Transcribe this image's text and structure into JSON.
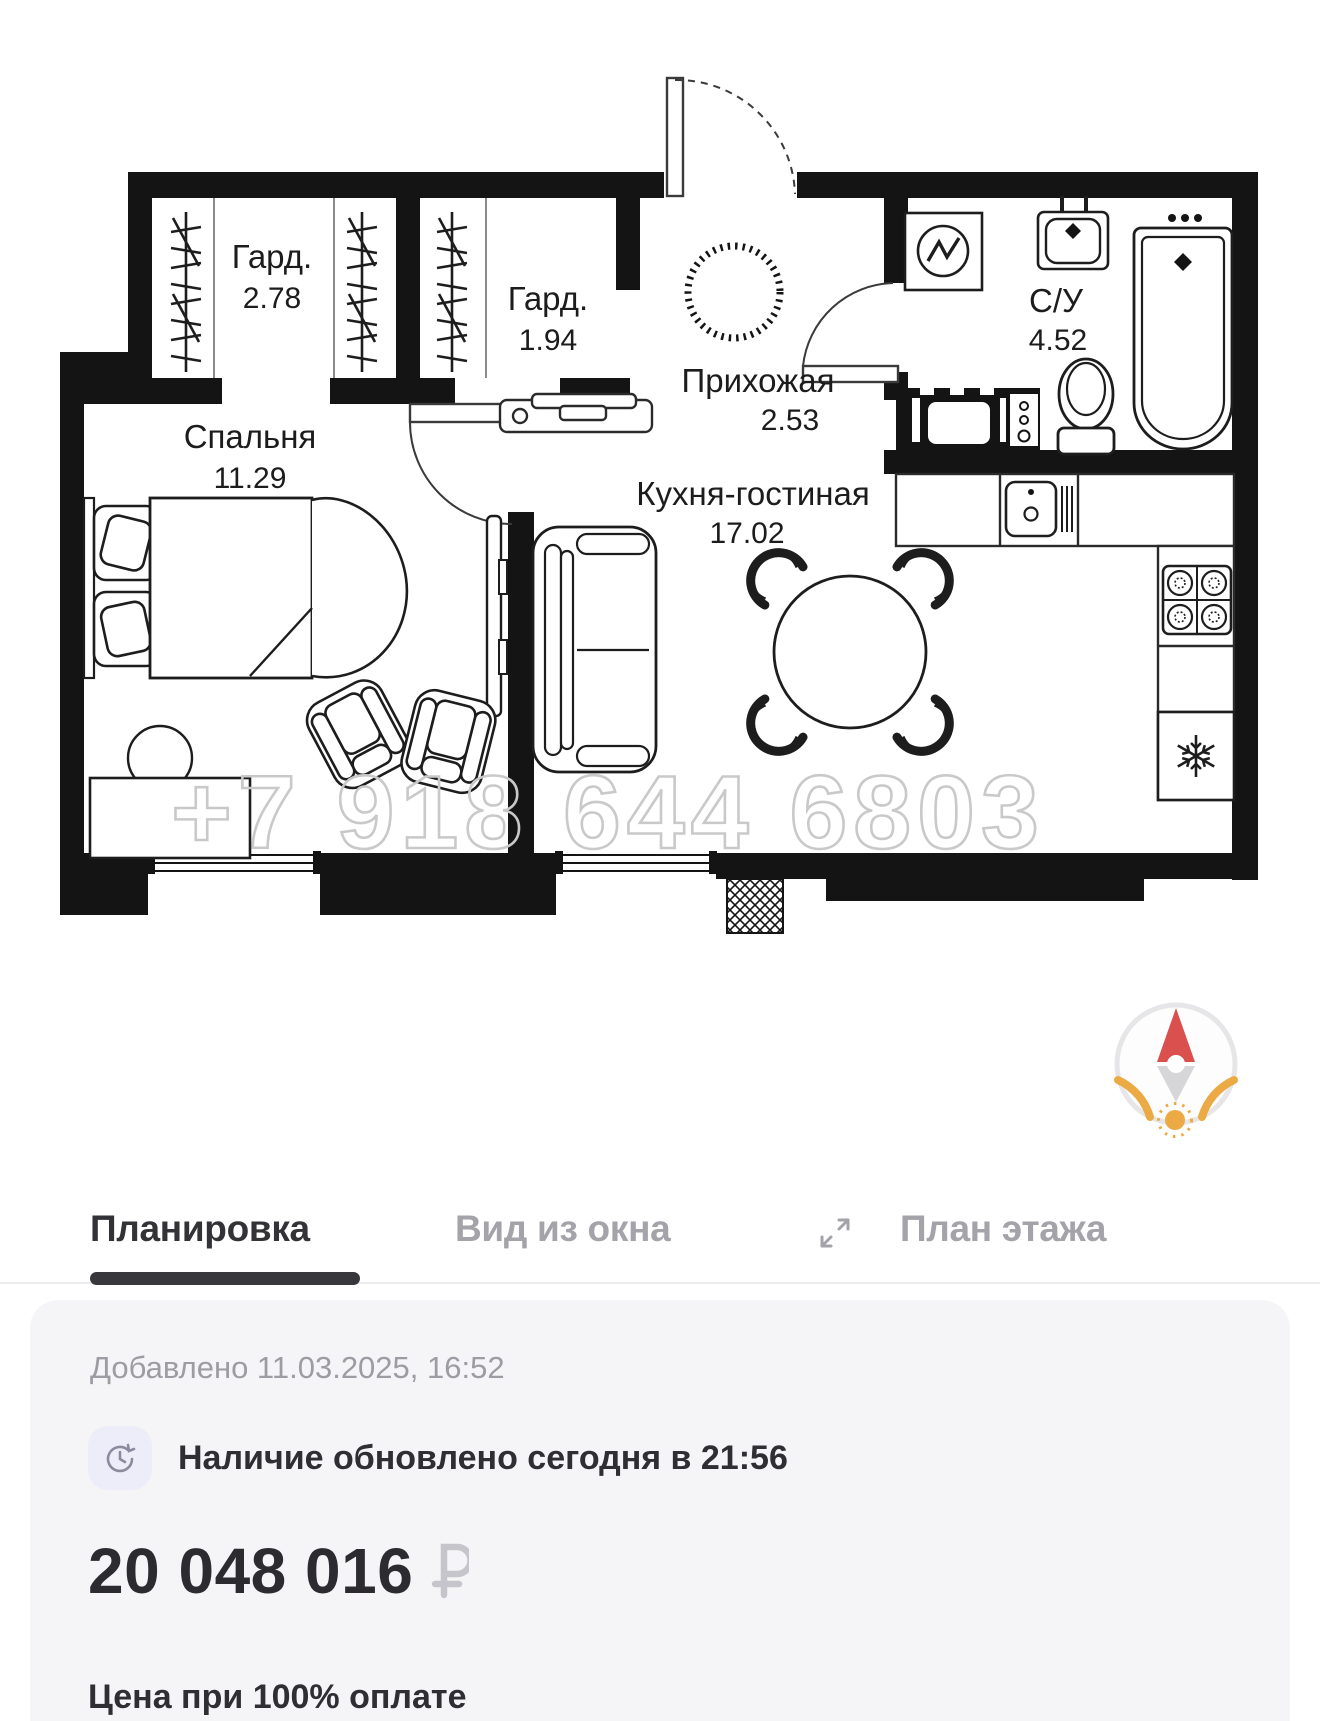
{
  "floor_plan": {
    "watermark": "+7 918 644 6803",
    "rooms": [
      {
        "name": "Гард.",
        "area": "2.78"
      },
      {
        "name": "Гард.",
        "area": "1.94"
      },
      {
        "name": "Прихожая",
        "area": "2.53"
      },
      {
        "name": "С/У",
        "area": "4.52"
      },
      {
        "name": "Спальня",
        "area": "11.29"
      },
      {
        "name": "Кухня-гостиная",
        "area": "17.02"
      }
    ],
    "fixtures": [
      "hanger-rack",
      "entrance-door",
      "electrical-panel",
      "washing-machine",
      "sink",
      "bathtub",
      "toilet",
      "kitchen-sink",
      "stove",
      "fridge",
      "sofa",
      "dining-table",
      "bed",
      "desk",
      "armchair",
      "tv",
      "window"
    ]
  },
  "compass": {
    "needle_up_color": "#d9504f",
    "needle_down_color": "#d6d6d9",
    "arc_color": "#ecaa44",
    "ring_color": "#e6e6e9",
    "sun_color": "#ecaa44"
  },
  "colors": {
    "walls": "#141414",
    "watermark": "#c9c9c9",
    "tab_active": "#333337",
    "tab_inactive": "#a3a3a9",
    "card_bg": "#f5f5f7",
    "badge_bg": "#ecedf8",
    "ruble": "#c5c5cb"
  },
  "tabs": [
    {
      "label": "Планировка",
      "active": true
    },
    {
      "label": "Вид из окна",
      "active": false
    },
    {
      "label": "План этажа",
      "active": false
    }
  ],
  "card": {
    "added": "Добавлено 11.03.2025, 16:52",
    "availability": "Наличие обновлено сегодня в 21:56",
    "price": "20 048 016",
    "currency": "₽",
    "price_note": "Цена при 100% оплате"
  }
}
